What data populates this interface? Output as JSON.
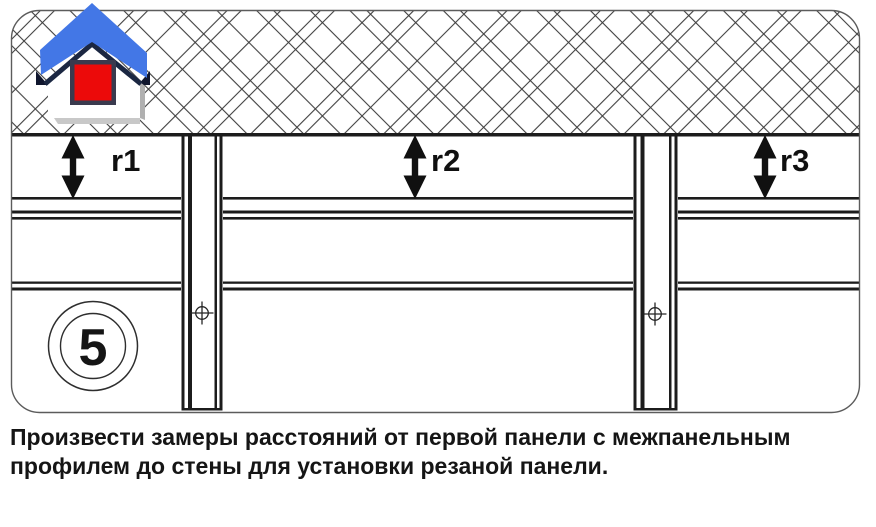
{
  "diagram": {
    "step_number": "5",
    "measurements": [
      {
        "id": "r1",
        "label": "r1"
      },
      {
        "id": "r2",
        "label": "r2"
      },
      {
        "id": "r3",
        "label": "r3"
      }
    ],
    "icons": {
      "logo": "house-icon",
      "fastener": "screw-target-icon",
      "measure": "double-headed-arrow-icon"
    }
  },
  "caption": {
    "line1": "Произвести замеры расстояний от первой панели с межпанельным",
    "line2": "профилем до стены для установки резаной панели."
  },
  "colors": {
    "line_dark": "#1c1c1c",
    "hatch_line": "#3f3f3f",
    "frame_border": "#5c5c5c",
    "roof_blue": "#4377e6",
    "roof_shadow": "#1b2742",
    "eave_dark": "#10162e",
    "window_red": "#ec0a0a",
    "window_frame": "#3a3a4e",
    "body_shadow": "#bdbdbd",
    "text": "#151515"
  }
}
